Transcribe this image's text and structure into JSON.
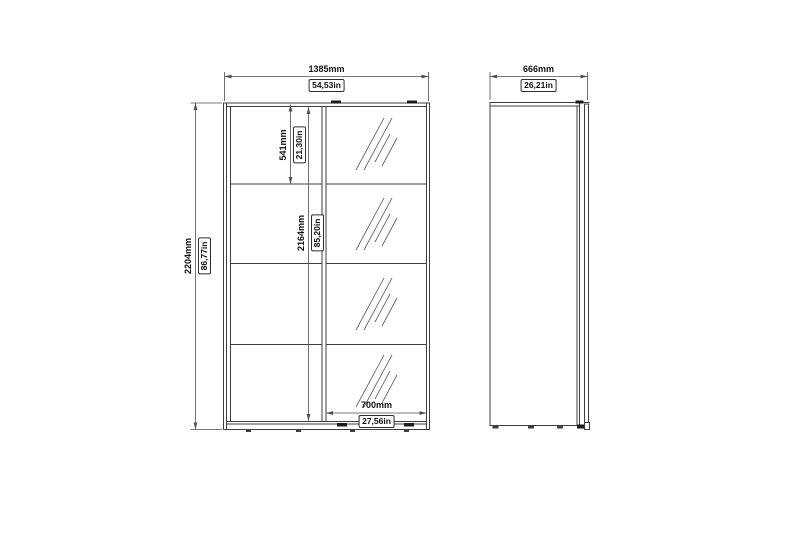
{
  "drawing": {
    "type": "furniture-dimension-diagram",
    "subject": "sliding-door-wardrobe-with-mirror",
    "colors": {
      "background": "#ffffff",
      "outline": "#3f3f3f",
      "dimension_line": "#4f4f4f",
      "text": "#111111"
    },
    "front_view": {
      "overall_width": {
        "mm": "1385mm",
        "in": "54,53in"
      },
      "overall_height": {
        "mm": "2204mm",
        "in": "86,77in"
      },
      "top_section_height": {
        "mm": "541mm",
        "in": "21,30in"
      },
      "interior_height": {
        "mm": "2164mm",
        "in": "85,20in"
      },
      "door_width": {
        "mm": "700mm",
        "in": "27,56in"
      }
    },
    "side_view": {
      "overall_depth": {
        "mm": "666mm",
        "in": "26,21in"
      }
    }
  }
}
